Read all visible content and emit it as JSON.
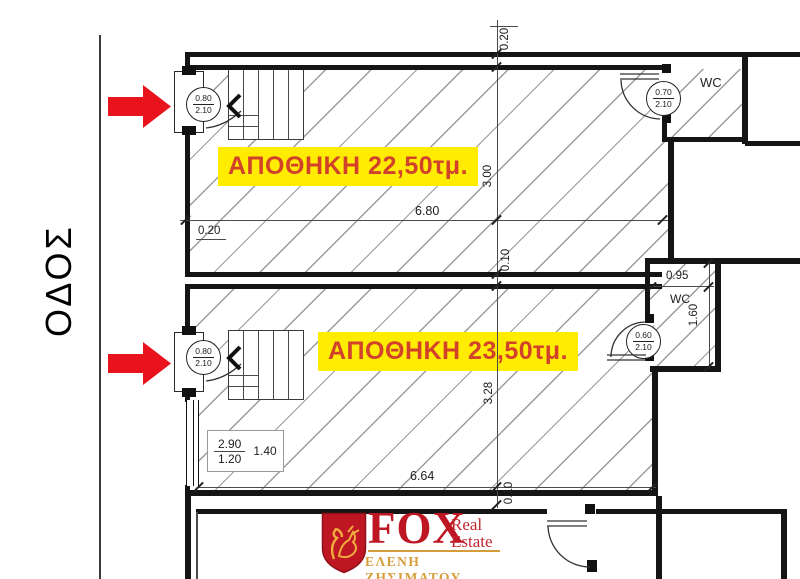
{
  "street_label": "ΟΔΟΣ",
  "unit1": {
    "label": "ΑΠΟΘΗΚΗ 22,50τμ.",
    "door_width": "0.80",
    "door_height": "2.10",
    "dim_width": "6.80",
    "dim_depth": "3.00",
    "dim_wall_top": "0.20",
    "dim_wall_left": "0.20",
    "dim_wall_mid": "0.10",
    "wc_label": "WC",
    "wc_door_width": "0.70",
    "wc_door_height": "2.10"
  },
  "unit2": {
    "label": "ΑΠΟΘΗΚΗ 23,50τμ.",
    "door_width": "0.80",
    "door_height": "2.10",
    "dim_width": "6.64",
    "dim_depth": "3.28",
    "dim_wall_bottom": "0.10",
    "window_top": "2.90",
    "window_bottom": "1.20",
    "window_side": "1.40",
    "wc_label": "WC",
    "wc_width": "0.95",
    "wc_depth": "1.60",
    "wc_door_width": "0.60",
    "wc_door_height": "2.10"
  },
  "logo": {
    "brand": "FOX",
    "line1": "Real",
    "line2": "Estate",
    "agent": "ΕΛΕΝΗ ΖΗΣΙΜΑΤΟΥ"
  },
  "colors": {
    "highlight": "#FFEC00",
    "label_text": "#D2422B",
    "arrow_red": "#E8131D",
    "logo_red": "#BE1622",
    "logo_gold": "#D49E3A",
    "wall": "#151515",
    "hatch_line": "#9B9B9B"
  }
}
